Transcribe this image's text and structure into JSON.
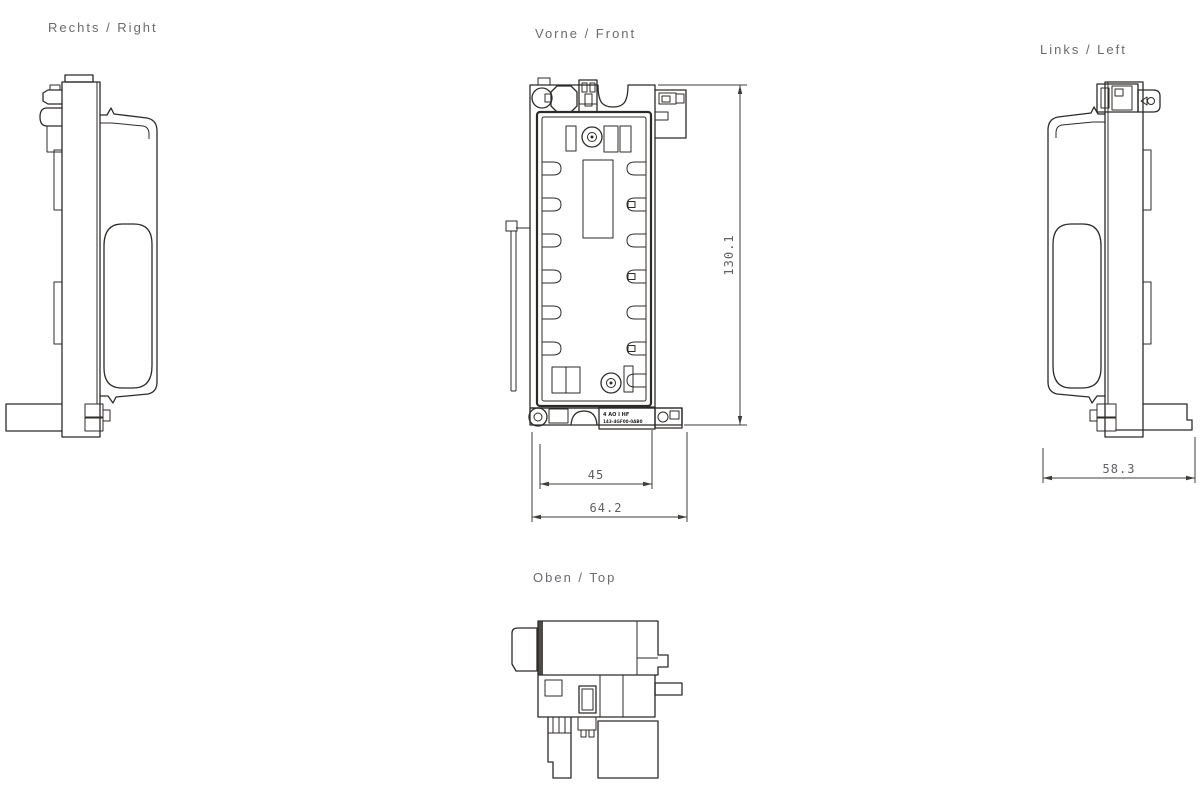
{
  "page": {
    "background": "#ffffff"
  },
  "views": {
    "right": {
      "label": "Rechts / Right"
    },
    "front": {
      "label": "Vorne / Front"
    },
    "left": {
      "label": "Links / Left"
    },
    "top": {
      "label": "Oben / Top"
    }
  },
  "dimensions": {
    "front_height": "130.1",
    "front_inner_width": "45",
    "front_overall_width": "64.2",
    "left_depth": "58.3"
  },
  "module_label": {
    "line1": "4 AO I HF",
    "line2": "143-4GF00-0AB0"
  },
  "colors": {
    "line": "#2d2b28",
    "dimension_line": "#3f3d3a",
    "label_text": "#6a6b6e",
    "dimension_text": "#5f6063",
    "background": "#ffffff"
  }
}
